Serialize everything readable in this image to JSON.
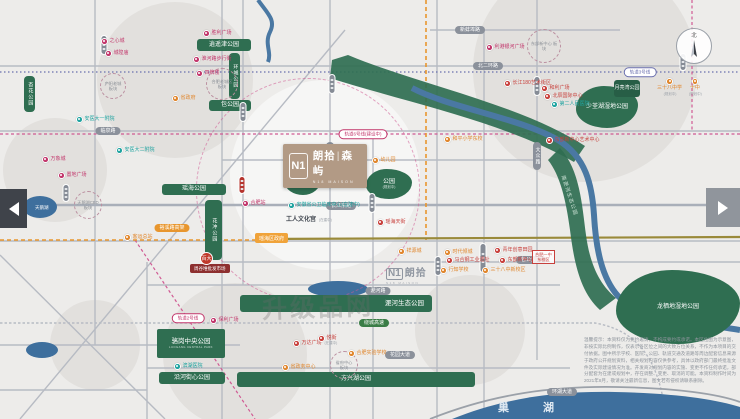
{
  "watermark": "升级品网",
  "compass": {
    "label": "北"
  },
  "lake": {
    "label": "巢湖"
  },
  "project": {
    "mark": "N1",
    "name_left": "朗拾",
    "sep": "|",
    "name_right": "森屿",
    "latin": "N18 MAISON"
  },
  "phase2": {
    "mark": "N1",
    "name": "朗拾",
    "latin": "N18 MAISON"
  },
  "disclaimer": "温馨提示：本资料仅为要约邀请，不构成要约或承诺。本区位图为示意图，非按实际比例制作，仅表示各区位之间的大致方位关系，不作为本项目的交付依据。图中所示学校、医院、公园、轨道交通及道路等周边配套信息来源于政府公开规划资料，相关规划内容仅供参考，具体以政府部门最终批准文件及实际建设情况为准。开发商对规划内容的实施、变更不作任何承诺，部分配套为在建或规划中，存在调整、变更、取消的可能。本资料制作时间为2021年8月，敬请关注最新信息，图文若有侵权请联系删除。",
  "map": {
    "parks": [
      {
        "t": "逍遥津公园",
        "shape": "bar",
        "x": 197,
        "y": 39,
        "w": 54,
        "h": 12
      },
      {
        "t": "环城公园",
        "shape": "vbar",
        "x": 229,
        "y": 53,
        "w": 11,
        "h": 46
      },
      {
        "t": "包公园",
        "shape": "bar",
        "x": 209,
        "y": 100,
        "w": 42,
        "h": 11
      },
      {
        "t": "瑶海公园",
        "shape": "bar",
        "x": 162,
        "y": 184,
        "w": 64,
        "h": 11
      },
      {
        "t": "花冲公园",
        "shape": "vbar",
        "x": 205,
        "y": 200,
        "w": 17,
        "h": 60
      },
      {
        "t": "杏花公园",
        "shape": "vbar",
        "x": 24,
        "y": 76,
        "w": 11,
        "h": 36
      },
      {
        "t": "公园",
        "sub": "(规划中)",
        "shape": "blob",
        "x": 285,
        "y": 167,
        "w": 36,
        "h": 28
      },
      {
        "t": "公园",
        "sub": "(规划中)",
        "shape": "blob",
        "x": 366,
        "y": 169,
        "w": 46,
        "h": 30
      },
      {
        "t": "少荃湖湿地公园",
        "shape": "blob",
        "x": 576,
        "y": 86,
        "w": 62,
        "h": 42
      },
      {
        "t": "月亮湾公园",
        "shape": "tag2",
        "x": 614,
        "y": 80,
        "w": 26,
        "h": 17
      },
      {
        "t": "淝河生态公园",
        "shape": "bar-right",
        "x": 240,
        "y": 295,
        "w": 192,
        "h": 17
      },
      {
        "t": "骆岗中央公园",
        "sub": "LUOGANG CENTRAL PARK",
        "shape": "block",
        "x": 157,
        "y": 329,
        "w": 68,
        "h": 29
      },
      {
        "t": "沿河街心公园",
        "shape": "bar",
        "x": 159,
        "y": 372,
        "w": 66,
        "h": 12
      },
      {
        "t": "方兴湖公园",
        "shape": "bar",
        "x": 237,
        "y": 372,
        "w": 238,
        "h": 15
      },
      {
        "t": "龙栖地湿地公园",
        "shape": "blob",
        "x": 616,
        "y": 270,
        "w": 124,
        "h": 74
      },
      {
        "t": "南淝河生态公园",
        "shape": "rot",
        "x": 558,
        "y": 190,
        "w": 20,
        "h": 12,
        "rot": 72
      }
    ],
    "pills": [
      {
        "t": "北二环路",
        "type": "gray",
        "x": 488,
        "y": 66
      },
      {
        "t": "临泉路",
        "type": "gray",
        "x": 108,
        "y": 131
      },
      {
        "t": "新蚌埠路",
        "type": "gray",
        "x": 470,
        "y": 30
      },
      {
        "t": "长江东路",
        "type": "gray",
        "x": 341,
        "y": 206
      },
      {
        "t": "包公大道",
        "type": "gray",
        "x": 531,
        "y": 260
      },
      {
        "t": "淝河路",
        "type": "gray",
        "x": 378,
        "y": 291
      },
      {
        "t": "花园大道",
        "type": "gray",
        "x": 400,
        "y": 355
      },
      {
        "t": "环湖大道",
        "type": "gray",
        "x": 562,
        "y": 392
      },
      {
        "t": "铜陵路",
        "type": "gray vert",
        "x": 330,
        "y": 156
      },
      {
        "t": "大众路",
        "type": "gray vert",
        "x": 537,
        "y": 156
      },
      {
        "t": "裕溪路高架",
        "type": "orange",
        "x": 172,
        "y": 228
      },
      {
        "t": "绕城高速",
        "type": "green",
        "x": 374,
        "y": 323
      },
      {
        "t": "轨道6号线(建设中)",
        "type": "metro",
        "x": 363,
        "y": 134
      },
      {
        "t": "轨道3号线",
        "type": "metro purple",
        "x": 640,
        "y": 72
      },
      {
        "t": "轨道2号线",
        "type": "metro",
        "x": 188,
        "y": 318
      }
    ],
    "stations": [
      {
        "x": 104,
        "y": 45,
        "h": 20
      },
      {
        "x": 332,
        "y": 84,
        "h": 20
      },
      {
        "x": 243,
        "y": 112,
        "h": 20
      },
      {
        "x": 537,
        "y": 86,
        "h": 20
      },
      {
        "x": 66,
        "y": 193,
        "h": 18
      },
      {
        "x": 372,
        "y": 203,
        "h": 20
      },
      {
        "x": 438,
        "y": 266,
        "h": 20
      },
      {
        "x": 483,
        "y": 258,
        "h": 30
      },
      {
        "x": 683,
        "y": 62,
        "h": 18
      },
      {
        "x": 242,
        "y": 185,
        "h": 18,
        "red": true
      }
    ],
    "zones": [
      {
        "t": "合肥老城区\n板块",
        "x": 222,
        "y": 84,
        "r": 16
      },
      {
        "t": "庐阳老城\n板块",
        "x": 113,
        "y": 86,
        "r": 13
      },
      {
        "t": "天鹅湖CBD\n板块",
        "x": 88,
        "y": 205,
        "r": 14
      },
      {
        "t": "东部新中心\n板块",
        "x": 544,
        "y": 46,
        "r": 17
      },
      {
        "t": "省府中心\n板块",
        "x": 344,
        "y": 365,
        "r": 14
      }
    ],
    "pois": [
      {
        "t": "胜利广场",
        "c": "#c2366b",
        "x": 203,
        "y": 30
      },
      {
        "t": "淮河路步行街",
        "c": "#c2366b",
        "x": 193,
        "y": 56
      },
      {
        "t": "四牌楼",
        "c": "#c2366b",
        "x": 196,
        "y": 70
      },
      {
        "t": "之心城",
        "c": "#c2366b",
        "x": 101,
        "y": 38
      },
      {
        "t": "城隍庙",
        "c": "#c2366b",
        "x": 105,
        "y": 50
      },
      {
        "t": "省政府",
        "c": "#e0862c",
        "x": 172,
        "y": 95
      },
      {
        "t": "安医大一附院",
        "c": "#1fa3a0",
        "x": 76,
        "y": 116
      },
      {
        "t": "万象城",
        "c": "#c2366b",
        "x": 42,
        "y": 156
      },
      {
        "t": "置地广场",
        "c": "#c2366b",
        "x": 58,
        "y": 172
      },
      {
        "t": "安医大二附院",
        "c": "#1fa3a0",
        "x": 116,
        "y": 147
      },
      {
        "t": "客运总站",
        "c": "#e0862c",
        "x": 124,
        "y": 234
      },
      {
        "t": "合肥站",
        "c": "#c2366b",
        "x": 242,
        "y": 200
      },
      {
        "t": "安徽省公卫临床中心(在建中)",
        "c": "#1fa3a0",
        "x": 288,
        "y": 202
      },
      {
        "t": "工人文化宫",
        "sub": "(在建中)",
        "type": "plain",
        "x": 286,
        "y": 217
      },
      {
        "t": "瑶海区政府",
        "type": "opill",
        "x": 255,
        "y": 233
      },
      {
        "t": "幼儿园",
        "c": "#e0862c",
        "x": 372,
        "y": 157
      },
      {
        "t": "瑶海天街",
        "c": "#c8403c",
        "x": 377,
        "y": 219
      },
      {
        "t": "周谷堆批发市场",
        "type": "dbar",
        "x": 190,
        "y": 264
      },
      {
        "t": "百大",
        "type": "redcircle",
        "x": 200,
        "y": 252
      },
      {
        "t": "长江180艺术街区",
        "c": "#c8403c",
        "x": 504,
        "y": 80
      },
      {
        "t": "和利广场",
        "c": "#c8403c",
        "x": 541,
        "y": 85
      },
      {
        "t": "北辰国际中心",
        "c": "#c8403c",
        "x": 544,
        "y": 93
      },
      {
        "t": "第二人民医院",
        "c": "#1fa3a0",
        "x": 551,
        "y": 101
      },
      {
        "t": "利港银河广场",
        "c": "#c2366b",
        "x": 486,
        "y": 44
      },
      {
        "t": "三十八中学",
        "sub": "(规划中)",
        "c": "#e0862c",
        "lp": "below",
        "x": 657,
        "y": 78
      },
      {
        "t": "十中",
        "sub": "(规划中)",
        "c": "#e0862c",
        "lp": "below",
        "x": 688,
        "y": 78
      },
      {
        "t": "和平小学东校",
        "c": "#e0862c",
        "x": 444,
        "y": 136
      },
      {
        "t": "东部新中心艺术中心",
        "c": "#c8403c",
        "x": 546,
        "y": 137
      },
      {
        "t": "祥源城",
        "c": "#e0862c",
        "x": 398,
        "y": 248
      },
      {
        "t": "时代倾城",
        "c": "#e0862c",
        "x": 444,
        "y": 249
      },
      {
        "t": "规划展示馆",
        "c": "#c8403c",
        "x": 443,
        "y": 247,
        "hide": true
      },
      {
        "t": "青年创意田园",
        "c": "#c8403c",
        "x": 494,
        "y": 247
      },
      {
        "t": "马合钢工业遗址",
        "c": "#c8403c",
        "x": 446,
        "y": 257
      },
      {
        "t": "东部新中心管委会",
        "c": "#c8403c",
        "x": 499,
        "y": 257
      },
      {
        "t": "行知学校",
        "c": "#e0862c",
        "x": 440,
        "y": 267
      },
      {
        "t": "三十八中新校区",
        "c": "#e0862c",
        "x": 482,
        "y": 267
      },
      {
        "t": "合肥一中\n东校区",
        "type": "rbox",
        "x": 532,
        "y": 250
      },
      {
        "t": "保利广场",
        "c": "#c2366b",
        "x": 210,
        "y": 317
      },
      {
        "t": "万达广场",
        "sub": "(在建中)",
        "c": "#c8403c",
        "x": 293,
        "y": 340
      },
      {
        "t": "悦街",
        "c": "#c8403c",
        "x": 318,
        "y": 335
      },
      {
        "t": "合肥实验学校",
        "c": "#e0862c",
        "x": 348,
        "y": 350
      },
      {
        "t": "省政务中心",
        "c": "#e0862c",
        "x": 282,
        "y": 364
      },
      {
        "t": "滨湖医院",
        "c": "#1fa3a0",
        "x": 174,
        "y": 363
      }
    ]
  }
}
